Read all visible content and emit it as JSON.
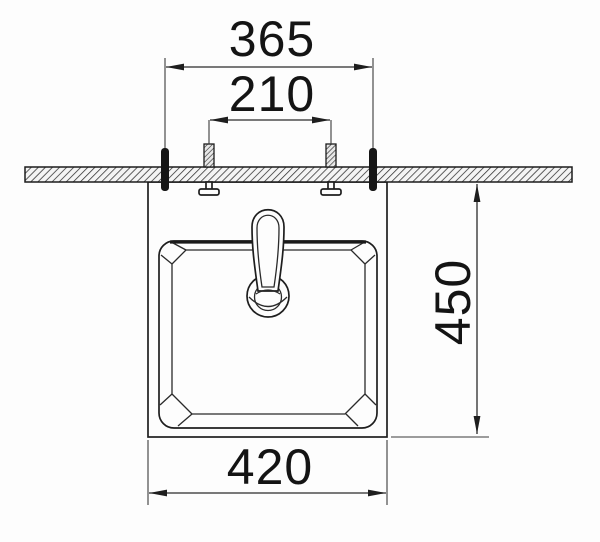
{
  "drawing": {
    "type": "installation-diagram-front-elevation",
    "dimensions": {
      "outer_fixing_span_mm": "365",
      "inner_fixing_span_mm": "210",
      "height_below_counter_mm": "450",
      "basin_width_mm": "420"
    },
    "colors": {
      "line": "#1e1e1e",
      "dimension_line": "#2b2b2b",
      "text": "#141414",
      "background": "#fdfdfd"
    }
  }
}
